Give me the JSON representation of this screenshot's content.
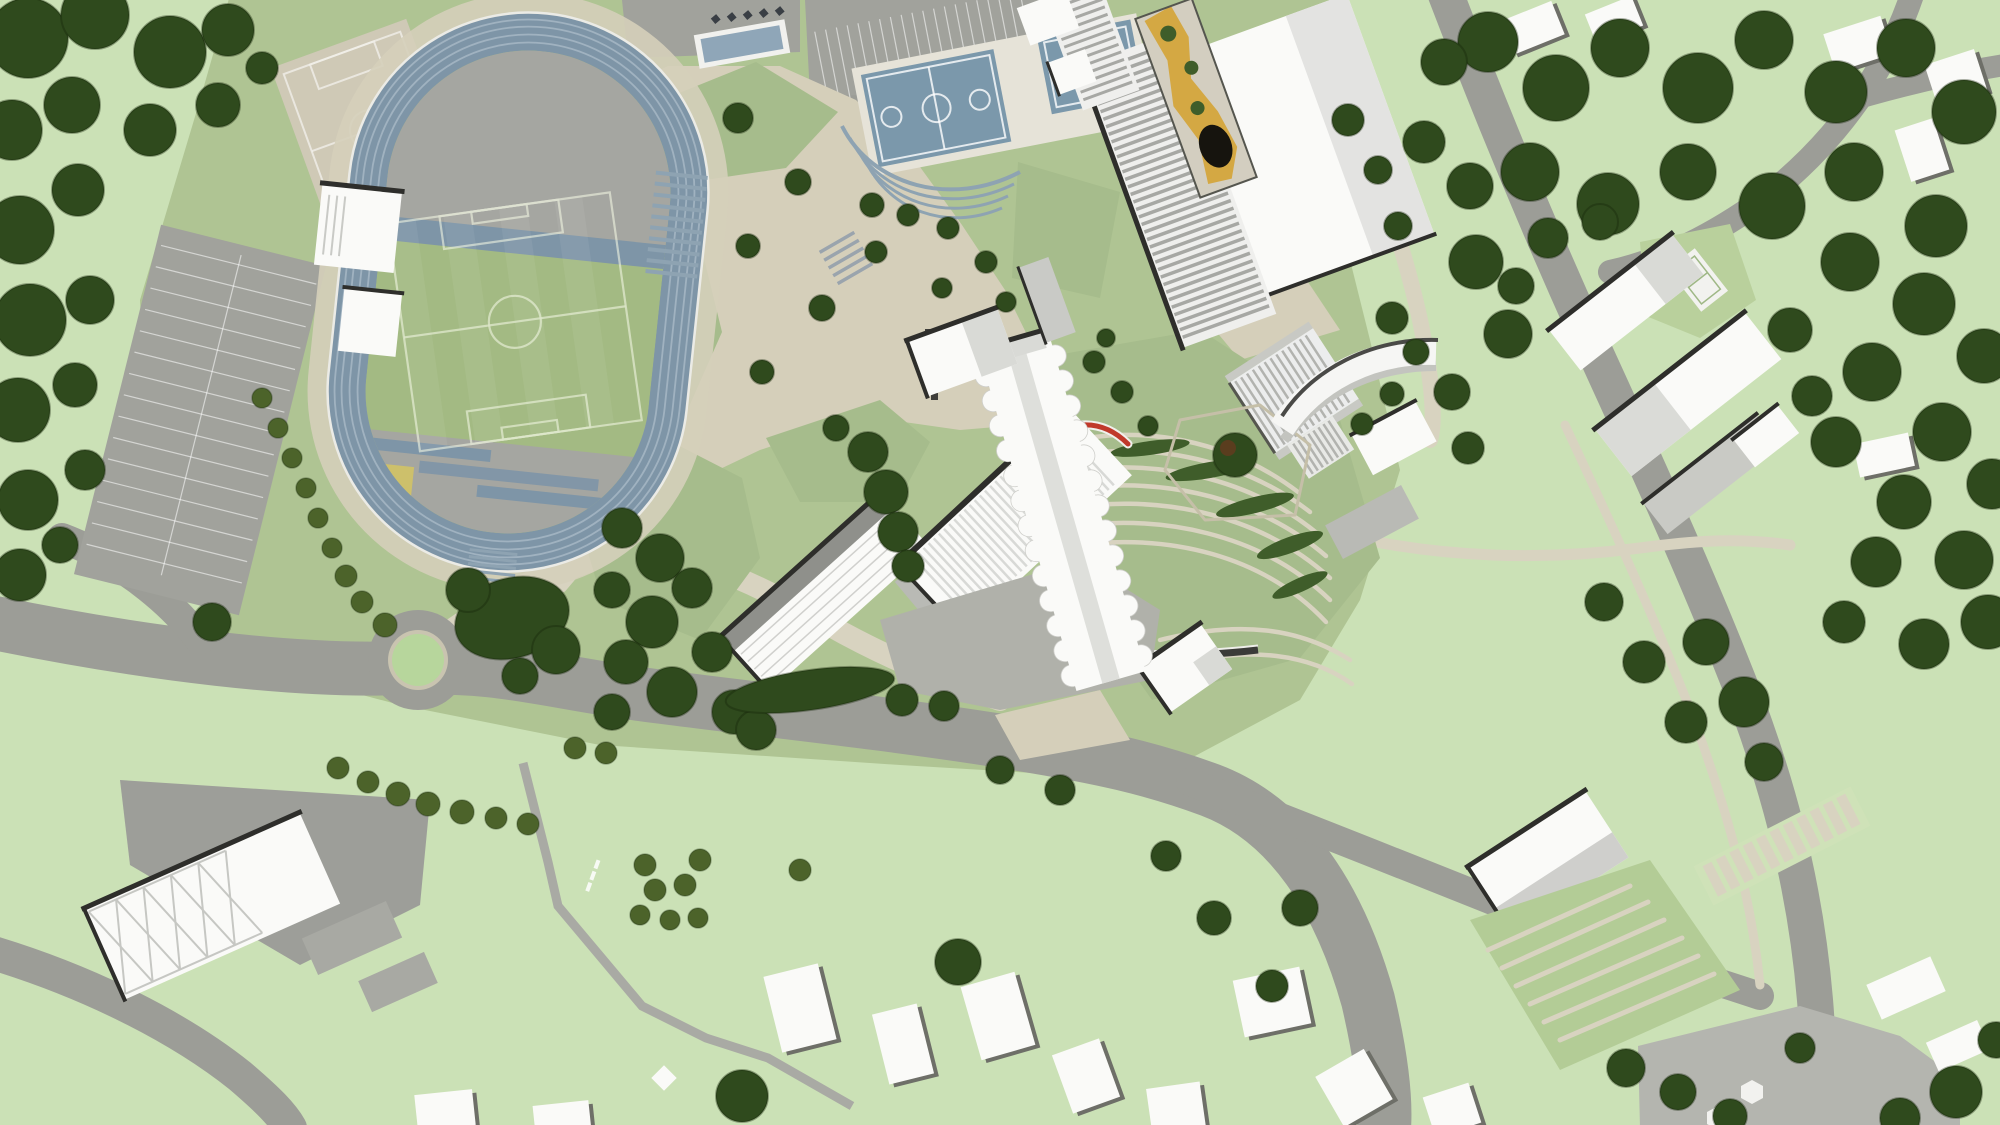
{
  "meta": {
    "title": "Campus site plan — aerial architectural rendering"
  },
  "canvas": {
    "width": 2000,
    "height": 1125
  },
  "palette": {
    "grass_bright": "#cbe1b6",
    "grass_olive": "#afc493",
    "field_green": "#a6bc8c",
    "pitch_green": "#a3ba83",
    "tree_dark": "#2f4a1d",
    "tree_olive": "#4c632a",
    "hedge_green": "#3f5d2a",
    "road_gray": "#9c9d97",
    "road_light": "#b0b1aa",
    "path_beige": "#d8d3c0",
    "plaza_beige": "#d5cfba",
    "parking_gray": "#a1a29c",
    "bld_white": "#fafaf8",
    "bld_gray": "#d9dad6",
    "bld_mdgray": "#b9bab5",
    "bld_dkgray": "#8f908b",
    "edge_dark": "#2e2e2b",
    "house_shadow": "#6e6f68",
    "track_blue": "#7e95a7",
    "track_line": "#a9bac7",
    "court_blue": "#7b98ab",
    "steps_blue": "#8ea3b2",
    "curb_white": "#ebebe6",
    "water_dark": "#16140e",
    "accent_yellow": "#d4a843",
    "accent_red": "#c0392b"
  },
  "features": [
    {
      "id": "running-track",
      "label": "400m running track"
    },
    {
      "id": "soccer-pitch",
      "label": "Soccer pitch infield"
    },
    {
      "id": "long-jump-strips",
      "label": "Long jump / athletics strips"
    },
    {
      "id": "practice-field",
      "label": "Practice field"
    },
    {
      "id": "grandstand-west",
      "label": "Grandstand buildings"
    },
    {
      "id": "bleachers-east",
      "label": "Trackside bleacher steps"
    },
    {
      "id": "west-parking",
      "label": "Main parking lot"
    },
    {
      "id": "north-parking",
      "label": "North parking lot"
    },
    {
      "id": "outdoor-pool",
      "label": "Small outdoor pool"
    },
    {
      "id": "basketball-courts",
      "label": "Basketball courts"
    },
    {
      "id": "amphitheater-steps",
      "label": "Curved amphitheater steps"
    },
    {
      "id": "north-school-building",
      "label": "Main school building with skylight roof"
    },
    {
      "id": "courtyard-garden",
      "label": "Courtyard garden with pond"
    },
    {
      "id": "central-hall",
      "label": "Central hall with vaulted roof"
    },
    {
      "id": "link-bridge",
      "label": "Link bridge"
    },
    {
      "id": "central-plaza",
      "label": "Central plaza"
    },
    {
      "id": "plaza-tree",
      "label": "Lone plaza tree"
    },
    {
      "id": "grand-staircase",
      "label": "Grand outdoor staircase"
    },
    {
      "id": "terraced-hillside",
      "label": "Terraced hillside garden"
    },
    {
      "id": "red-slide",
      "label": "Red slide"
    },
    {
      "id": "gym-a",
      "label": "Sports hall A"
    },
    {
      "id": "gym-b",
      "label": "Sports hall B with ribbed roof"
    },
    {
      "id": "southeast-annex",
      "label": "Southeast annex building"
    },
    {
      "id": "upper-school-cluster",
      "label": "Upper campus buildings"
    },
    {
      "id": "upper-courtyard-court",
      "label": "Upper courtyard play court"
    },
    {
      "id": "arc-building",
      "label": "Curved building row"
    },
    {
      "id": "terrace-building",
      "label": "Building with terraced gardens"
    },
    {
      "id": "industrial-building",
      "label": "Warehouse with truss roof"
    },
    {
      "id": "roundabout",
      "label": "Roundabout"
    },
    {
      "id": "main-road",
      "label": "Main road"
    },
    {
      "id": "ring-road",
      "label": "Eastern ring road"
    },
    {
      "id": "corner-plaza",
      "label": "Paved corner plaza"
    },
    {
      "id": "residential-houses",
      "label": "Residential houses"
    },
    {
      "id": "forest",
      "label": "Forest trees"
    },
    {
      "id": "footpaths",
      "label": "Campus footpaths"
    }
  ]
}
